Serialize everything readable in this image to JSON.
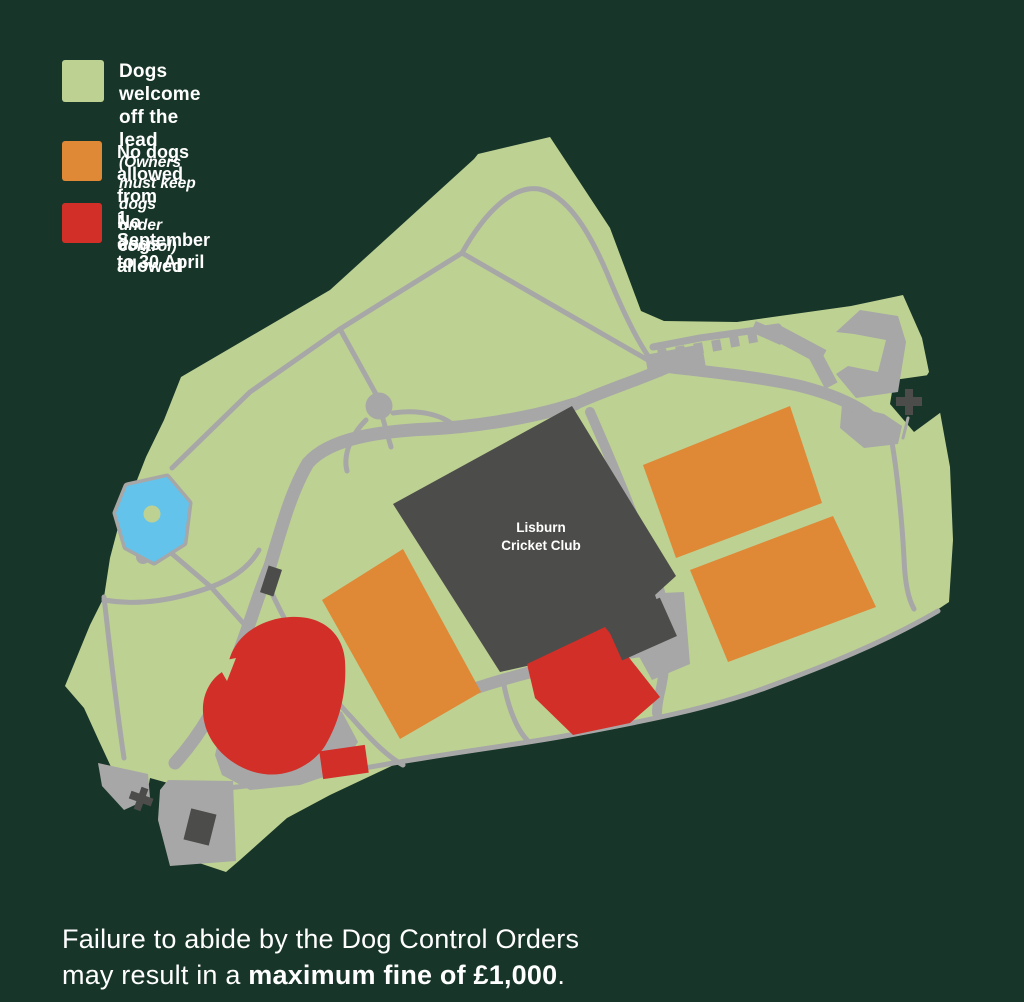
{
  "colors": {
    "background": "#173528",
    "park_green": "#bdd193",
    "path_gray": "#a7a7a7",
    "dark_gray": "#4c4c4a",
    "orange": "#df8836",
    "red": "#d22f28",
    "pond_blue": "#63c3ea",
    "text_white": "#ffffff"
  },
  "legend": {
    "items": [
      {
        "line1": "Dogs welcome off the lead",
        "line2": "(Owners must keep dogs under control)"
      },
      {
        "line1": "No dogs allowed from",
        "line2": "1 September to 30 April"
      },
      {
        "line1": "No dogs allowed"
      }
    ]
  },
  "map": {
    "venue_label_line1": "Lisburn",
    "venue_label_line2": "Cricket Club"
  },
  "footer": {
    "line1": "Failure to abide by the Dog Control Orders",
    "line2_normal": "may result in a ",
    "line2_bold": "maximum fine of £1,000",
    "line2_end": "."
  }
}
